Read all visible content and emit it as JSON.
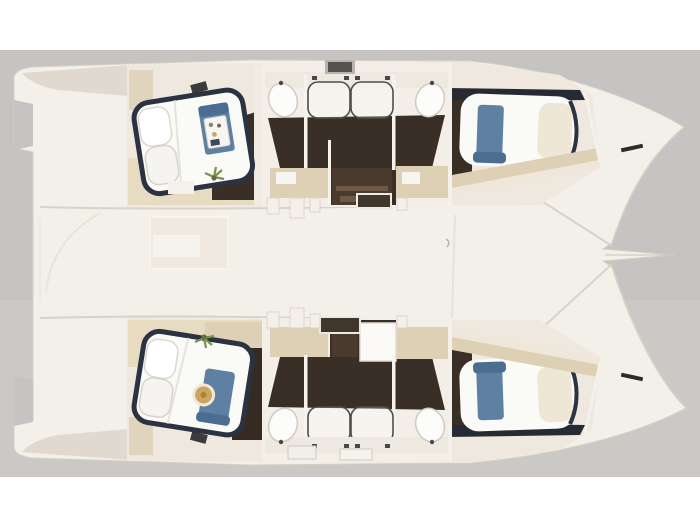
{
  "scene": {
    "kind": "catamaran-floor-plan-render",
    "view": "top-down cutaway",
    "orientation": "bows pointing right, sterns left",
    "backdrop": "gray studio band with white page margins"
  },
  "palette": {
    "page_bg": "#ffffff",
    "backdrop_gray": "#c6c4c2",
    "backdrop_gray_light": "#cfcdcb",
    "deck_white": "#f3f0e9",
    "wall_light": "#eee8de",
    "stern_shade": "#d9d1c6",
    "floor_dark_wood": "#3a2f26",
    "corridor_wood": "#4a3b2e",
    "step_wood": "#6e5942",
    "cabinet_beige": "#ddd0b5",
    "floor_beige": "#e7dbc2",
    "bed_linen": "#fafaf7",
    "pillow_cream": "#efe7d6",
    "bed_frame_navy": "#2b3342",
    "runner_blue": "#5e80a3",
    "runner_blue_dark": "#4b6d92",
    "tray_white": "#f6f5f2",
    "tray_gold": "#cda45f",
    "plant_green": "#7c9052",
    "glass_stroke": "#4d4d4b",
    "hatch_dark": "#3f362c",
    "hatch_gray": "#55534f",
    "edge_line": "#d8d2c8",
    "dark_band": "#262b33"
  },
  "boat": {
    "type": "sailing catamaran",
    "cabins_count": 4,
    "bathrooms_count": 2,
    "hulls": [
      {
        "id": "port-hull",
        "position": "top",
        "rooms": [
          {
            "type": "aft-cabin",
            "features": [
              "island-double-bed",
              "two-pillows",
              "blue-runner",
              "serving-tray",
              "plant"
            ]
          },
          {
            "type": "bathroom",
            "features": [
              "twin-sinks",
              "double-shower-glass",
              "roof-hatch",
              "beige-cabinets"
            ]
          },
          {
            "type": "forward-cabin",
            "features": [
              "double-bed",
              "blue-runner",
              "cream-pillow",
              "beige-shelf"
            ]
          }
        ]
      },
      {
        "id": "starboard-hull",
        "position": "bottom",
        "rooms": [
          {
            "type": "aft-cabin",
            "features": [
              "island-double-bed",
              "two-pillows",
              "blue-runner",
              "round-gold-tray",
              "plant"
            ]
          },
          {
            "type": "bathroom",
            "features": [
              "twin-sinks",
              "double-shower-glass",
              "shower-tray",
              "beige-cabinets"
            ]
          },
          {
            "type": "forward-cabin",
            "features": [
              "double-bed",
              "blue-runner",
              "cream-pillow",
              "beige-shelf"
            ]
          }
        ]
      }
    ],
    "deck_features": [
      "cockpit",
      "bridge-deck",
      "bowsprit-sliver",
      "companionway-hatches",
      "bow-cleats"
    ]
  }
}
